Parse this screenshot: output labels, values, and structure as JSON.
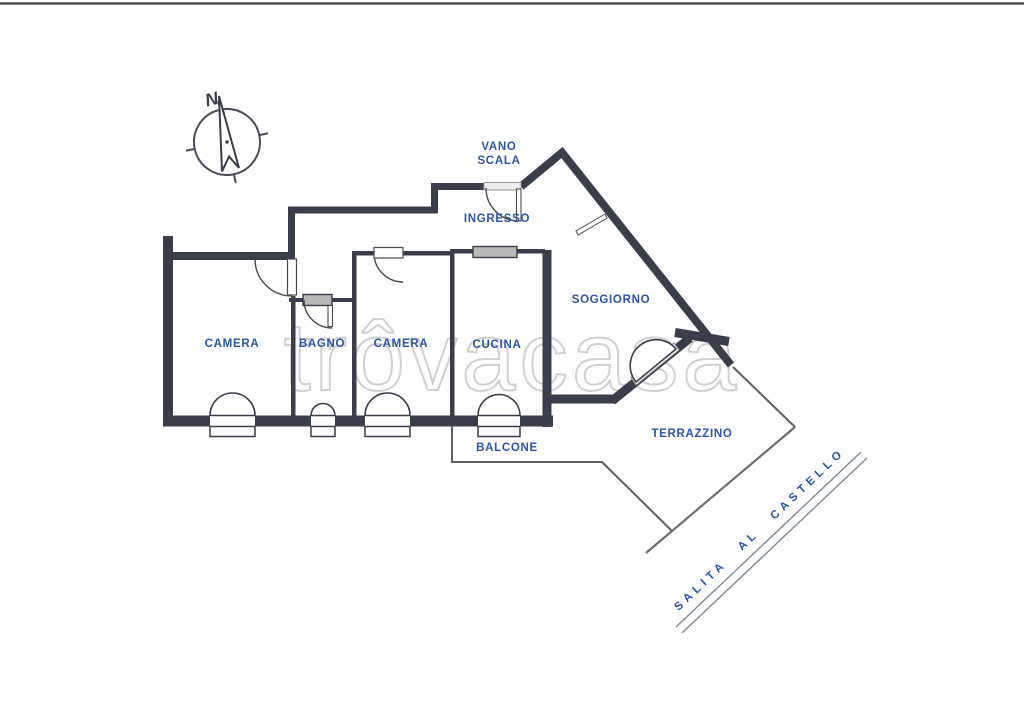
{
  "floor_plan": {
    "watermark": "trôvacasa",
    "compass": {
      "north_label": "N"
    },
    "colors": {
      "wall": "#3a3e4a",
      "label_blue": "#2b55a5",
      "door_line": "#4a4a4a",
      "thin_line": "#5b5f66",
      "site_line": "#7d8893",
      "watermark_gray": "#d0d0d0",
      "window_fill": "#b9b9b9",
      "scan_border": "#4f4f4f"
    },
    "rooms": {
      "vano_scala_line1": "VANO",
      "vano_scala_line2": "SCALA",
      "ingresso": "INGRESSO",
      "camera_left": "CAMERA",
      "bagno": "BAGNO",
      "camera_mid": "CAMERA",
      "cucina": "CUCINA",
      "soggiorno": "SOGGIORNO",
      "balcone": "BALCONE",
      "terrazzino": "TERRAZZINO"
    },
    "street": "SALITA AL CASTELLO"
  }
}
